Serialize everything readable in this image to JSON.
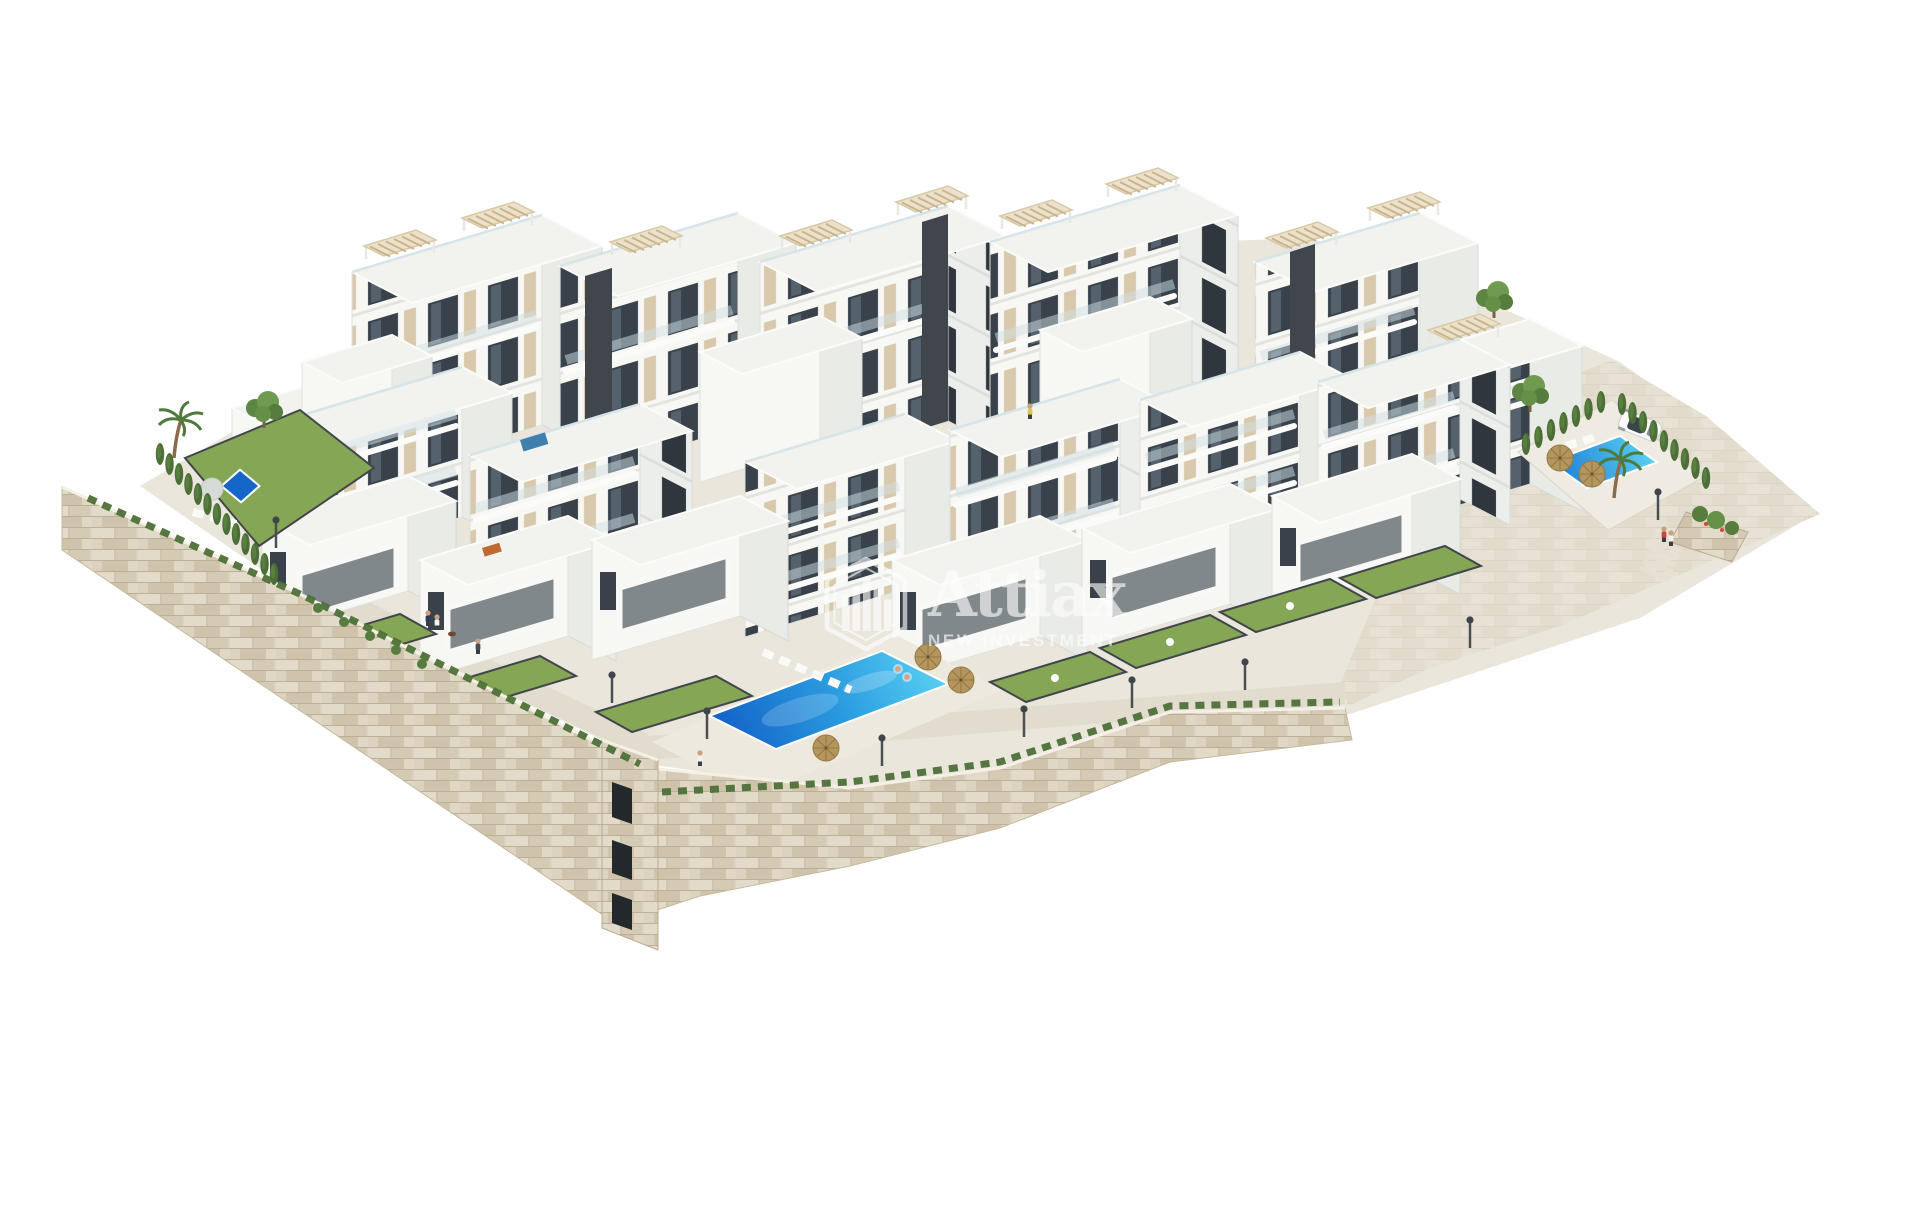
{
  "scene": {
    "description": "Aerial 3D architectural rendering of a hillside residential development: stepped white apartment blocks with beige accents and rooftop pergolas, terraced private gardens, three turquoise swimming pools, beige stone retaining walls, palm trees, cypress hedges, street lamps, a parked white car and small human figures, on a plain white background.",
    "background_color": "#ffffff"
  },
  "watermark": {
    "brand": "Attiax",
    "tagline": "NEW INVESTMENT",
    "icon": "buildings-badge-icon",
    "color": "#ffffff",
    "opacity": 0.62
  },
  "site": {
    "pool_count": 3,
    "parked_cars": 1,
    "features": [
      "white apartment blocks",
      "rooftop pergolas",
      "balconies with glass railings",
      "terraced lawns with dark fences",
      "central community pool with sun loungers and straw umbrellas",
      "east pool deck with parked car",
      "small private garden pool",
      "stone retaining walls with staircase tower",
      "cypress hedges and palm trees",
      "street lamps and walking people"
    ]
  },
  "palette": {
    "building_white": "#f7f7f4",
    "building_side": "#e9ebe6",
    "roof_white": "#f2f2ee",
    "accent_beige": "#d5c5a9",
    "accent_dark": "#41464c",
    "window_glass": "#39424b",
    "glass_rail": "#cfe0e6",
    "lawn_green": "#85a655",
    "lawn_light": "#9aba6d",
    "hedge_green": "#4e7038",
    "pool_light": "#5ad0f2",
    "pool_deep": "#1566c9",
    "stone_wall": "#dbd2c0",
    "stone_line": "#bdb098",
    "paving": "#eae6dc",
    "walkway": "#e2dccf",
    "umbrella_straw": "#b2955f",
    "trunk": "#8a6b4a"
  }
}
